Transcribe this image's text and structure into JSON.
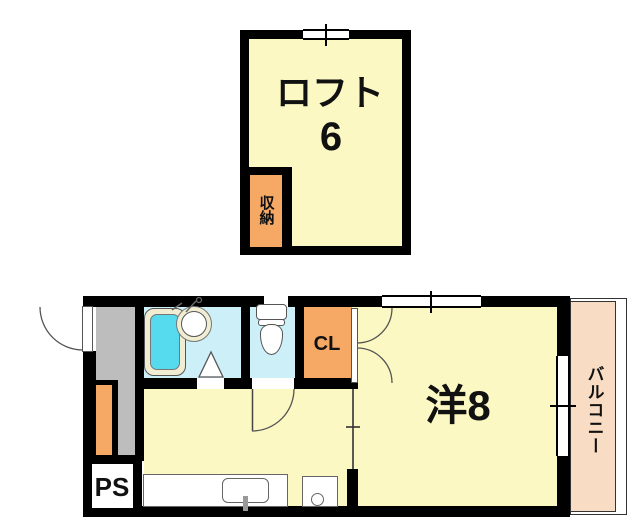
{
  "floorplan": {
    "labels": {
      "loft": "ロフト",
      "loft_size": "6",
      "storage": "収納",
      "closet": "CL",
      "western_room": "洋8",
      "balcony": "バルコニー",
      "pipe_space": "PS"
    },
    "colors": {
      "wall": "#000000",
      "room_fill": "#FCF8C3",
      "accent_orange": "#F5A964",
      "balcony_fill": "#F8DCC3",
      "wet_area_fill": "#CDEFF8",
      "bathtub_fill": "#55DAEE",
      "hallway_fill": "#BDBDBD"
    }
  }
}
